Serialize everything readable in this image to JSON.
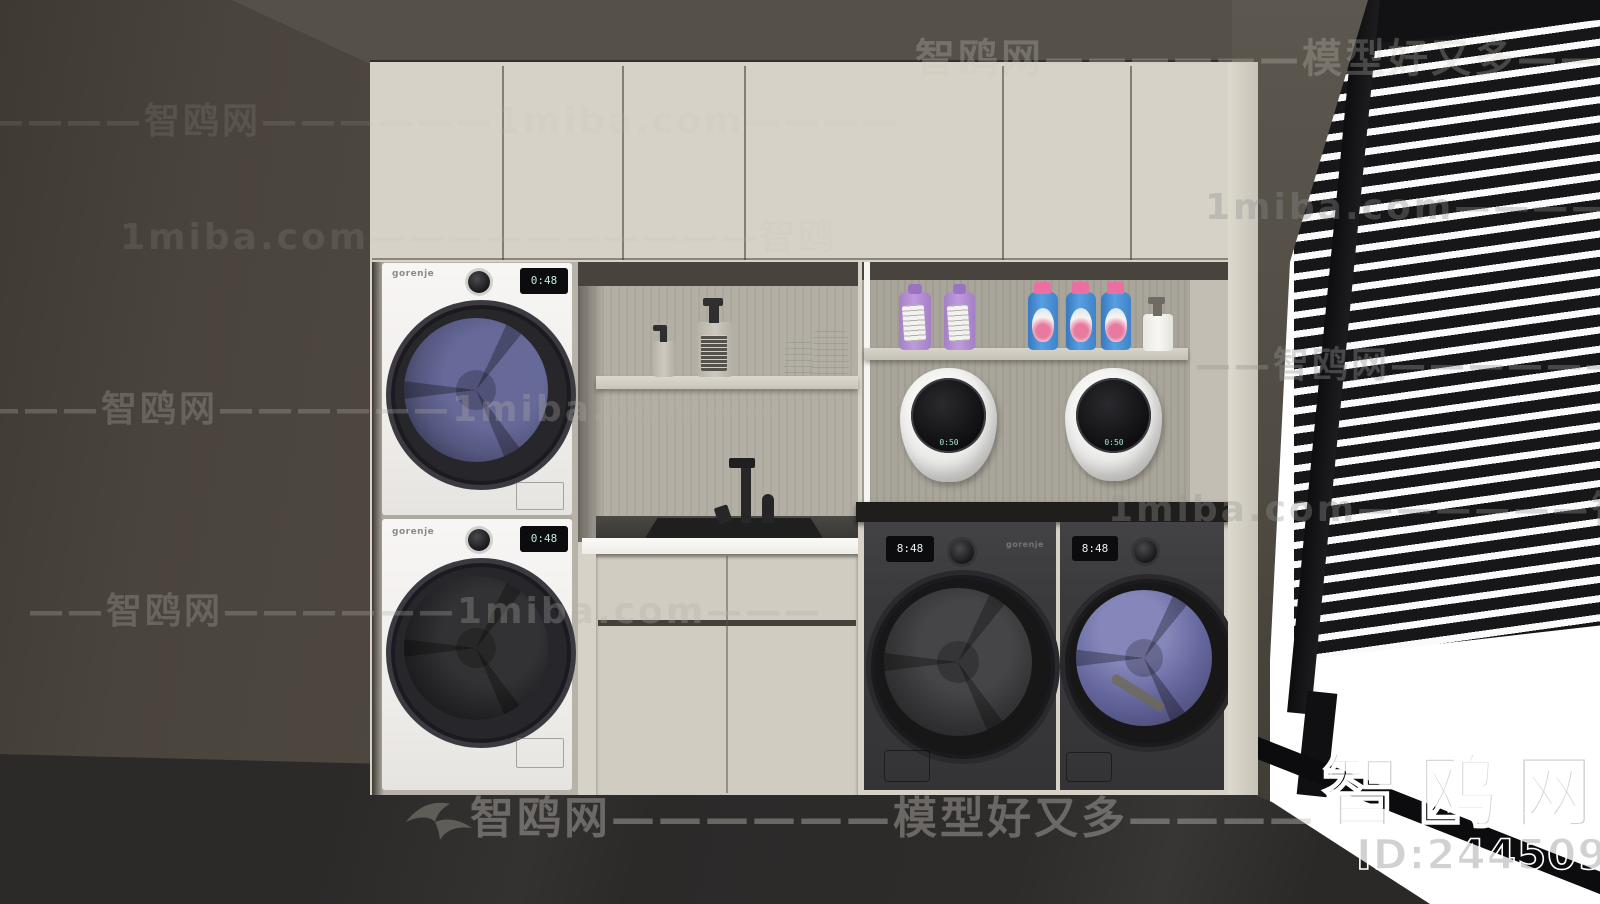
{
  "watermarks": {
    "rows": [
      {
        "text": "智鸥网——————模型好又多————"
      },
      {
        "text": "——————智鸥网——————1miba.com————"
      },
      {
        "text": "1miba.com——————————智鸥"
      },
      {
        "text": "1miba.com——————智鸥网————"
      },
      {
        "text": "——智鸥网——————1miba.com——"
      },
      {
        "text": "————智鸥网——————1miba.com——"
      },
      {
        "text": "1miba.com——————智鸥网——"
      },
      {
        "text": "——智鸥网——————1miba.com———"
      },
      {
        "text": "智鸥网——————模型好又多————"
      }
    ]
  },
  "branding": {
    "logo_text": "智鸥网",
    "model_id": "ID:244509945"
  },
  "appliances": {
    "brand": "gorenje",
    "washer_display": "0:48",
    "dryer_display": "0:48",
    "wall_washer_display": "0:50",
    "dark_washer_display": "8:48",
    "dark_dryer_display": "8:48"
  },
  "colors": {
    "wall": "#49443c",
    "ceiling": "#55504a",
    "cabinet_cream": "#d6d2c7",
    "niche_wood": "#aba79c",
    "floor": "#2d2b2a",
    "blinds_slat": "#17171a",
    "drum_purple": "#62639b",
    "bottle_blue": "#4a8fd4",
    "bottle_cap_pink": "#ec6fa3",
    "bottle_purple": "#b38fd2",
    "display_teal": "#bfe7e0"
  }
}
